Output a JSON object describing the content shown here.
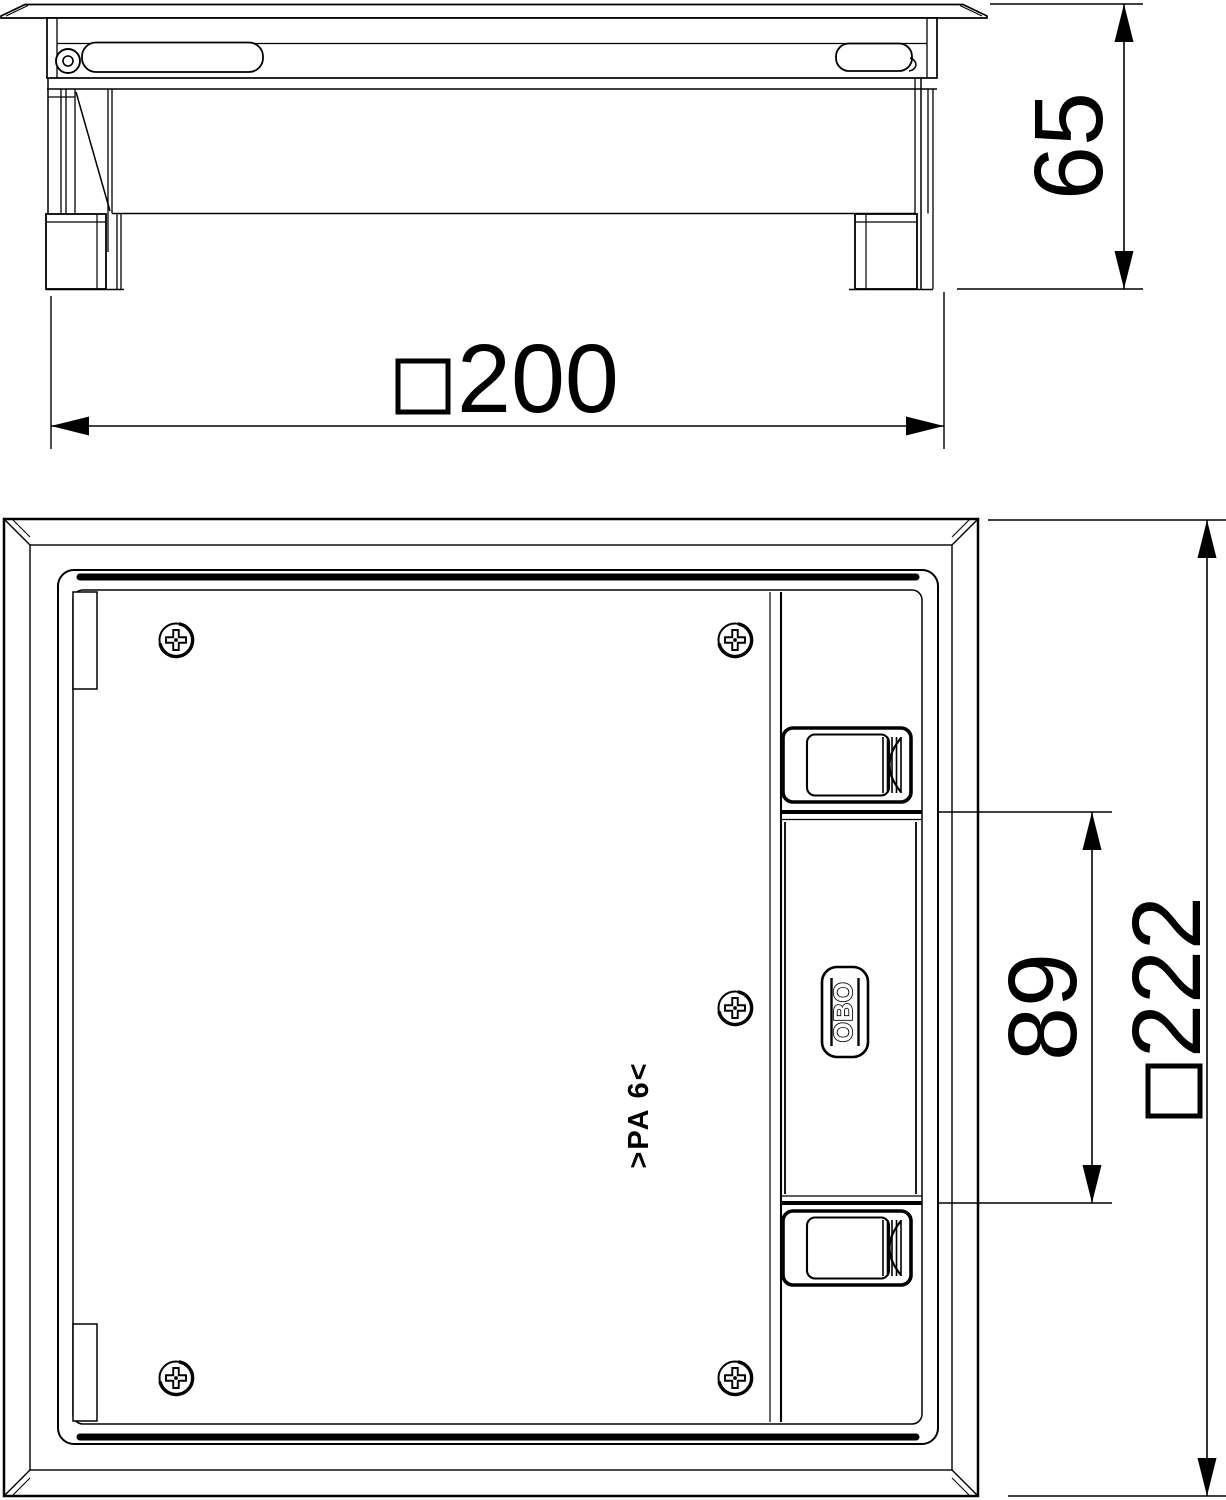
{
  "drawing": {
    "side_view": {
      "dim_height": "65",
      "dim_width": "200",
      "dim_width_prefix": "□"
    },
    "plan_view": {
      "dim_strip": "89",
      "dim_overall": "222",
      "dim_overall_prefix": "□",
      "logo": "OBO",
      "material_marking": ">PA 6<"
    },
    "colors": {
      "line": "#000000",
      "background": "#ffffff"
    }
  }
}
